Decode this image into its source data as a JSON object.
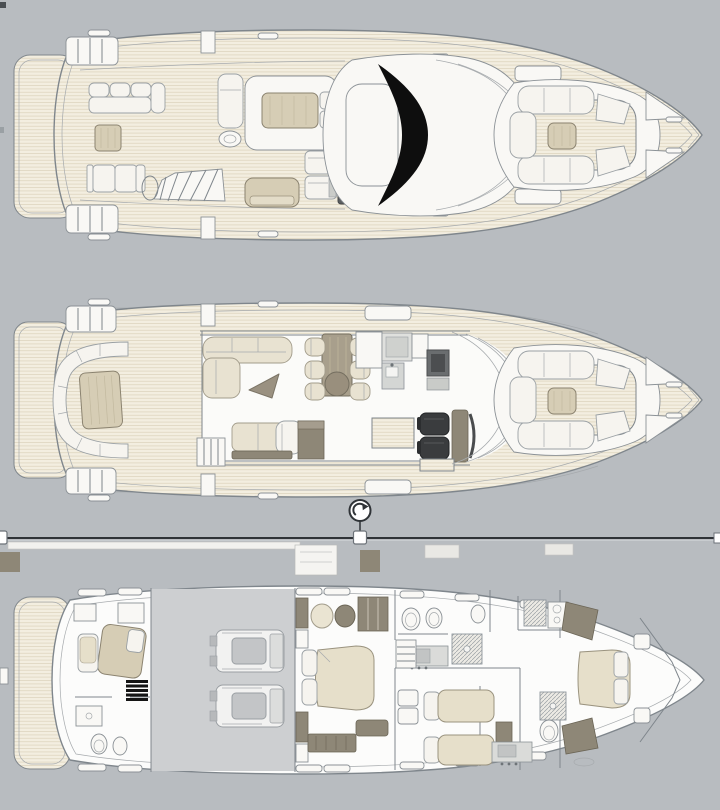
{
  "canvas": {
    "width": 720,
    "height": 810,
    "background": "#b8bcc0"
  },
  "colors": {
    "bg": "#b8bcc0",
    "outline": "#7f868c",
    "teak": "#f3eee0",
    "teakLine": "#ded5c0",
    "whiteFiberglass": "#f9f8f5",
    "cushionWhite": "#f6f4ef",
    "cushionCream": "#e8e2d1",
    "padBeige": "#d6cdb5",
    "taupe": "#8e8777",
    "darkSeat": "#3a3c3e",
    "windshieldBlack": "#0e0e0e",
    "engineRoomFloor": "#cdcfd1",
    "selection": "#2f3337",
    "handleFill": "#ffffff",
    "handleStroke": "#6c7278"
  },
  "decks": [
    {
      "id": "flybridge-deck"
    },
    {
      "id": "main-deck"
    },
    {
      "id": "lower-deck",
      "selected": true
    }
  ],
  "selection_overlay": {
    "rotate_icon": "rotate-clockwise-icon",
    "handle_shape": "square",
    "handles": [
      "left-edge",
      "top-center",
      "right-edge"
    ],
    "line_y": 538
  }
}
